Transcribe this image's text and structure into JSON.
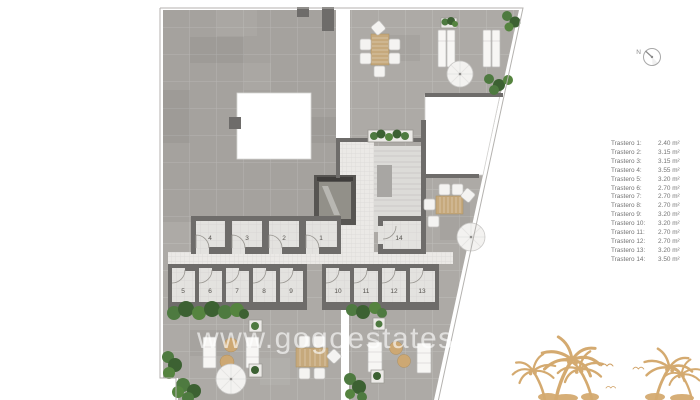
{
  "plan": {
    "rooms": [
      "4",
      "3",
      "2",
      "1",
      "14",
      "5",
      "6",
      "7",
      "8",
      "9",
      "10",
      "11",
      "12",
      "13"
    ]
  },
  "legend": {
    "items": [
      {
        "label": "Trastero 1:",
        "value": "2.40 m²"
      },
      {
        "label": "Trastero 2:",
        "value": "3.15 m²"
      },
      {
        "label": "Trastero 3:",
        "value": "3.15 m²"
      },
      {
        "label": "Trastero 4:",
        "value": "3.55 m²"
      },
      {
        "label": "Trastero 5:",
        "value": "3.20 m²"
      },
      {
        "label": "Trastero 6:",
        "value": "2.70 m²"
      },
      {
        "label": "Trastero 7:",
        "value": "2.70 m²"
      },
      {
        "label": "Trastero 8:",
        "value": "2.70 m²"
      },
      {
        "label": "Trastero 9:",
        "value": "3.20 m²"
      },
      {
        "label": "Trastero 10:",
        "value": "3.20 m²"
      },
      {
        "label": "Trastero 11:",
        "value": "2.70 m²"
      },
      {
        "label": "Trastero 12:",
        "value": "2.70 m²"
      },
      {
        "label": "Trastero 13:",
        "value": "3.20 m²"
      },
      {
        "label": "Trastero 14:",
        "value": "3.50 m²"
      }
    ]
  },
  "compass": {
    "label": "N"
  },
  "watermark": {
    "text": "www.gogoestates.c"
  },
  "colors": {
    "terrace": "#adaaa6",
    "wall": "#6e6c6a",
    "room_floor": "#e3e2df",
    "hedge": "#4e7a40",
    "wood": "#c6a97c",
    "palm": "#d4aa70",
    "legend_text": "#747474"
  }
}
